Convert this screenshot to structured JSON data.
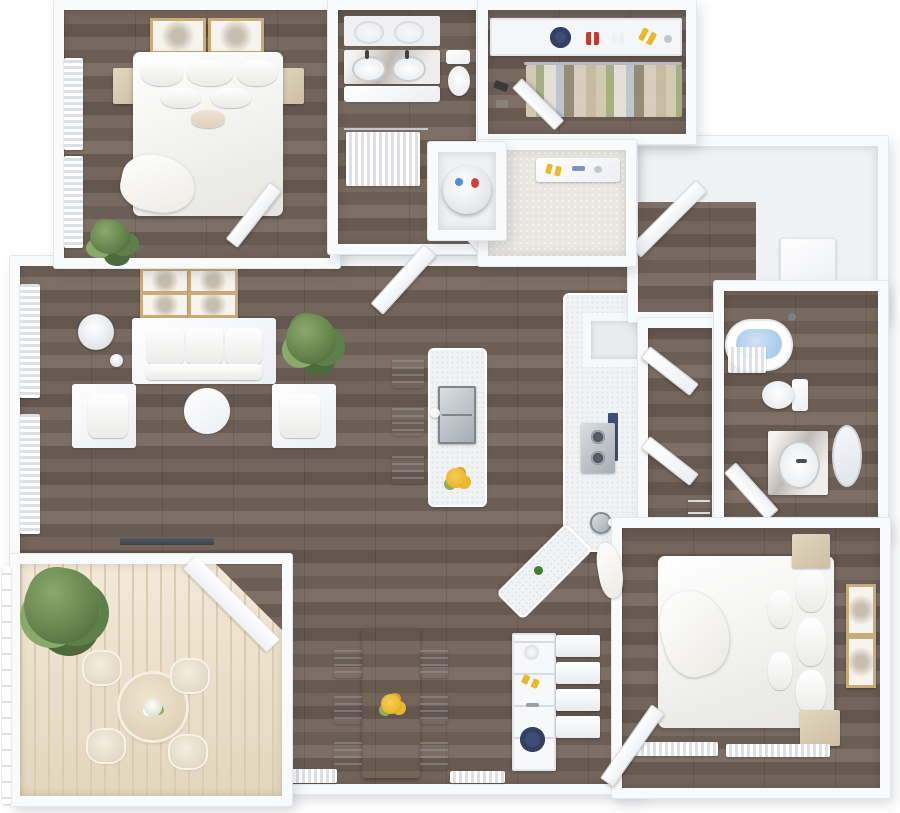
{
  "scene": {
    "type": "floor-plan-3d-render",
    "view": "top-down",
    "unit_style": "two-bedroom two-bath apartment with balcony",
    "rooms": [
      {
        "name": "bedroom-1",
        "items": [
          "double bed with white bedding",
          "nightstand left",
          "nightstand right",
          "framed wall art x2",
          "curtained windows x2",
          "potted plant",
          "door"
        ]
      },
      {
        "name": "bathroom-1",
        "items": [
          "marble double-sink vanity",
          "mirror reflection",
          "toilet",
          "shower with curtain",
          "door"
        ]
      },
      {
        "name": "utility-closet",
        "items": [
          "water heater with red and blue lines"
        ]
      },
      {
        "name": "walk-in-closet",
        "items": [
          "top shelf with navy sun hat, red shoes, white sandals, yellow shoes",
          "hanging clothes rod",
          "floor shoes",
          "door"
        ]
      },
      {
        "name": "hall-closet",
        "items": [
          "bench with yellow shoes and accessories",
          "tile floor"
        ]
      },
      {
        "name": "laundry-hall",
        "items": [
          "white cabinet",
          "open door"
        ]
      },
      {
        "name": "living-room",
        "items": [
          "three-seat white sofa",
          "armchair x2",
          "round white coffee table",
          "floor lamp",
          "gallery wall art x4",
          "potted plant",
          "sheer curtained windows x3",
          "balcony slider threshold"
        ]
      },
      {
        "name": "kitchen",
        "items": [
          "white island with stainless sink and faucet",
          "bar stool x3",
          "yellow fruit bowl",
          "counter run",
          "refrigerator nook",
          "gas cooktop",
          "navy backsplash panel",
          "round counter sink",
          "green bottle"
        ]
      },
      {
        "name": "dining-area",
        "items": [
          "light wood dining table",
          "white dining chair x6",
          "sunflower centerpiece",
          "curtained windows x2"
        ]
      },
      {
        "name": "entry",
        "items": [
          "shelf unit with glass, yellow shoes and navy hat",
          "entry steps",
          "open front door"
        ]
      },
      {
        "name": "hallway-2",
        "items": [
          "linen closet open doors x2",
          "shelves"
        ]
      },
      {
        "name": "bathroom-2",
        "items": [
          "bathtub with water",
          "shower curtain",
          "shower head",
          "toilet",
          "marble vanity with sink",
          "oval mirror",
          "door"
        ]
      },
      {
        "name": "bedroom-2",
        "items": [
          "double bed with white bedding",
          "nightstand x2",
          "framed wall art x2",
          "curtained windows",
          "throw blanket"
        ]
      },
      {
        "name": "balcony",
        "items": [
          "whitewashed deck planks",
          "round patio table",
          "woven patio chair x4",
          "white flower centerpiece",
          "large potted tree",
          "left railing",
          "chamfered corner wall"
        ]
      }
    ]
  },
  "palette": {
    "wall": "#f9fafc",
    "wall_edge": "#e3e6ea",
    "wood": "#6e6157",
    "deck": "#ecdfc6",
    "deck_line": "#dbcdb0",
    "tile": "#e9e7e2",
    "gold": "#c9ac79",
    "navy": "#3f4d74",
    "green": "#5f7f4a",
    "green_light": "#8aa96c",
    "yellow": "#eab82d",
    "red": "#c33a31",
    "water": "#abcdea"
  }
}
